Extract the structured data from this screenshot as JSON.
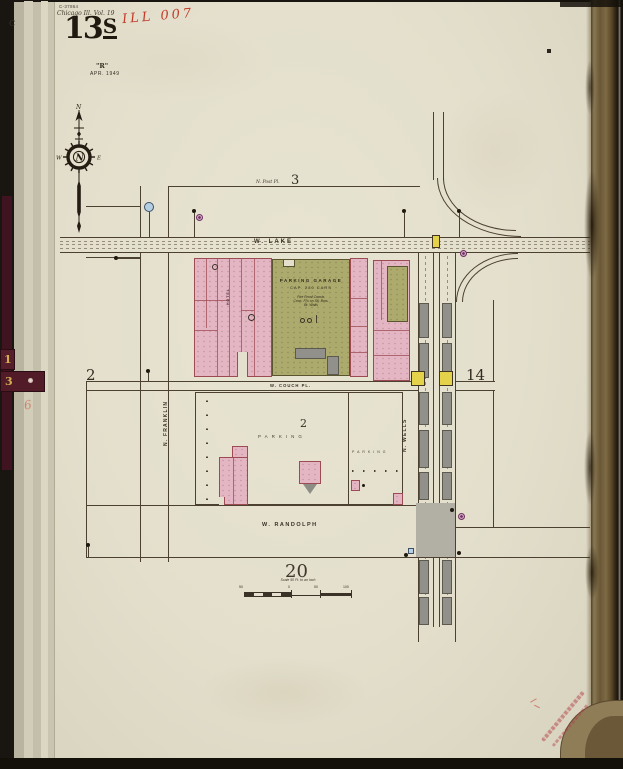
{
  "page_header": {
    "catalog_number": "C-37864",
    "volume_line": "Chicago Ill. Vol. 19",
    "handwritten_id": "ILL 007",
    "sheet_prefix": "13",
    "sheet_suffix": "S",
    "revision_letter": "\"R\"",
    "revision_date": "APR. 1949",
    "edge_letter": "C"
  },
  "binder_tabs": {
    "tab1": "1",
    "tab2": "3",
    "pencil_mark": "6"
  },
  "compass": {
    "north": "N",
    "west": "W",
    "east": "E"
  },
  "streets": {
    "lake": "W. LAKE",
    "couch": "W. COUCH PL.",
    "randolph": "W. RANDOLPH",
    "franklin": "N. FRANKLIN",
    "wells": "N. WELLS",
    "post_place": "N. Post Pl."
  },
  "sheet_numbers": {
    "north_block": "3",
    "west_block": "2",
    "center_block": "2",
    "east_block": "14",
    "south_block": "20"
  },
  "labels": {
    "parking_garage": {
      "name": "PARKING GARAGE",
      "capacity": "CAP. 280 CARS",
      "note1": "Fire Proof Constr.",
      "note2": "Conc. Fl's on Stl. Bms.",
      "note3": "Br. Walls"
    },
    "hotel": "HOTEL",
    "parking_lot_1": "PARKING",
    "parking_lot_2": "PARKING"
  },
  "scale_bar": {
    "caption": "Scale 50 Ft. to an Inch",
    "ticks": [
      "50",
      "0",
      "50",
      "100"
    ]
  }
}
